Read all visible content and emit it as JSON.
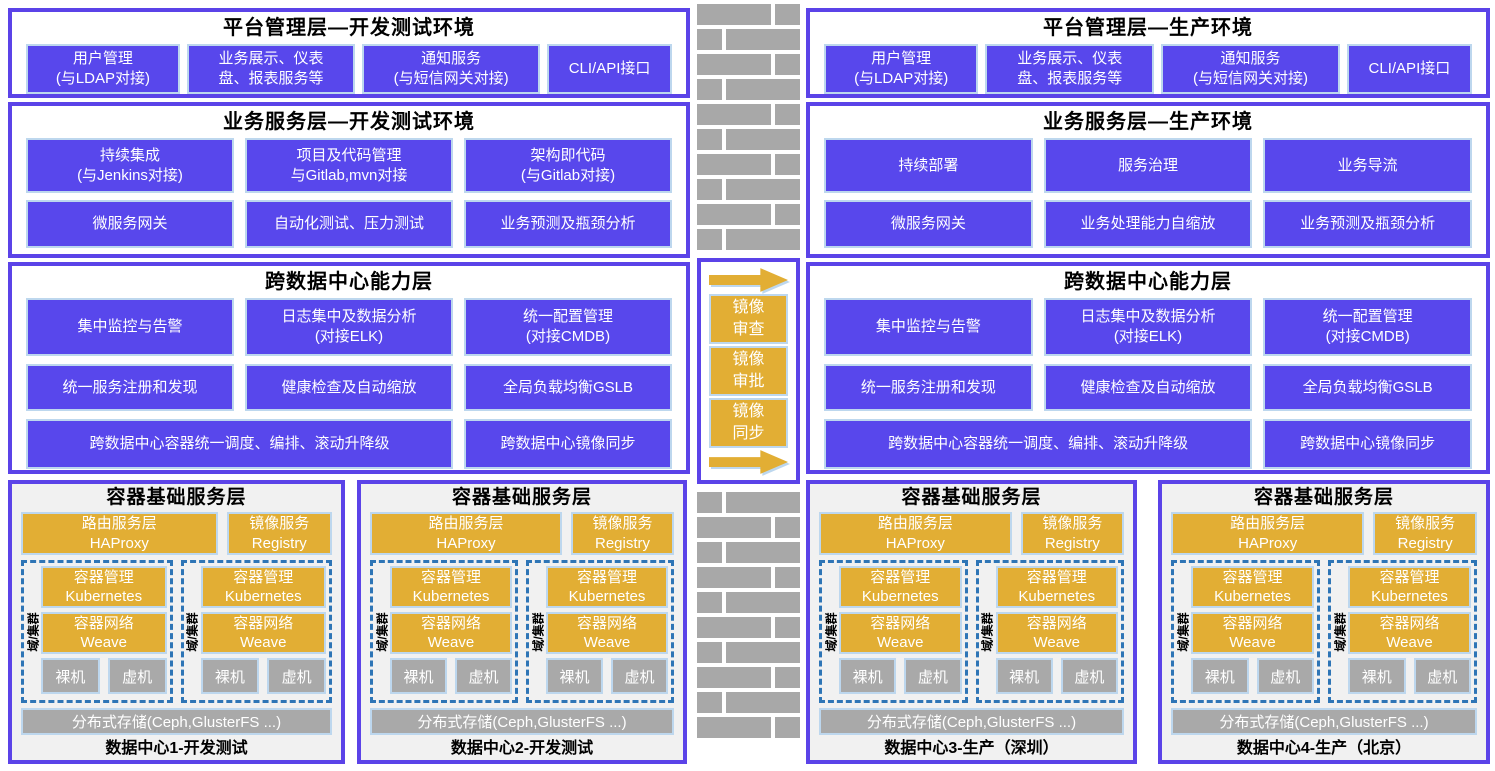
{
  "colors": {
    "purple_fill": "#5847EC",
    "panel_border": "#5B43E8",
    "light_blue_border": "#BDD7EE",
    "yellow": "#E2AE34",
    "gray": "#A9A9A9",
    "brick_gray": "#A8A8A8",
    "dashed_cluster_border": "#2E75B6",
    "dc_panel_bg": "#F1F1F1",
    "text_on_fill": "#FFFFFF"
  },
  "left": {
    "platform": {
      "title": "平台管理层—开发测试环境",
      "boxes": [
        "用户管理\n(与LDAP对接)",
        "业务展示、仪表\n盘、报表服务等",
        "通知服务\n(与短信网关对接)",
        "CLI/API接口"
      ]
    },
    "business": {
      "title": "业务服务层—开发测试环境",
      "row1": [
        "持续集成\n(与Jenkins对接)",
        "项目及代码管理\n与Gitlab,mvn对接",
        "架构即代码\n(与Gitlab对接)"
      ],
      "row2": [
        "微服务网关",
        "自动化测试、压力测试",
        "业务预测及瓶颈分析"
      ]
    },
    "crossdc": {
      "title": "跨数据中心能力层",
      "row1": [
        "集中监控与告警",
        "日志集中及数据分析\n(对接ELK)",
        "统一配置管理\n(对接CMDB)"
      ],
      "row2": [
        "统一服务注册和发现",
        "健康检查及自动缩放",
        "全局负载均衡GSLB"
      ],
      "wide": "跨数据中心容器统一调度、编排、滚动升降级",
      "sync": "跨数据中心镜像同步"
    }
  },
  "right": {
    "platform": {
      "title": "平台管理层—生产环境",
      "boxes": [
        "用户管理\n(与LDAP对接)",
        "业务展示、仪表\n盘、报表服务等",
        "通知服务\n(与短信网关对接)",
        "CLI/API接口"
      ]
    },
    "business": {
      "title": "业务服务层—生产环境",
      "row1": [
        "持续部署",
        "服务治理",
        "业务导流"
      ],
      "row2": [
        "微服务网关",
        "业务处理能力自缩放",
        "业务预测及瓶颈分析"
      ]
    },
    "crossdc": {
      "title": "跨数据中心能力层",
      "row1": [
        "集中监控与告警",
        "日志集中及数据分析\n(对接ELK)",
        "统一配置管理\n(对接CMDB)"
      ],
      "row2": [
        "统一服务注册和发现",
        "健康检查及自动缩放",
        "全局负载均衡GSLB"
      ],
      "wide": "跨数据中心容器统一调度、编排、滚动升降级",
      "sync": "跨数据中心镜像同步"
    }
  },
  "middle": {
    "steps": [
      "镜像\n审查",
      "镜像\n审批",
      "镜像\n同步"
    ]
  },
  "dc": {
    "title": "容器基础服务层",
    "routing": "路由服务层\nHAProxy",
    "registry": "镜像服务\nRegistry",
    "cluster_label": "域/集群",
    "k8s": "容器管理\nKubernetes",
    "net": "容器网络\nWeave",
    "bare": "裸机",
    "vm": "虚机",
    "storage": "分布式存储(Ceph,GlusterFS ...)",
    "names": [
      "数据中心1-开发测试",
      "数据中心2-开发测试",
      "数据中心3-生产（深圳）",
      "数据中心4-生产（北京）"
    ]
  }
}
